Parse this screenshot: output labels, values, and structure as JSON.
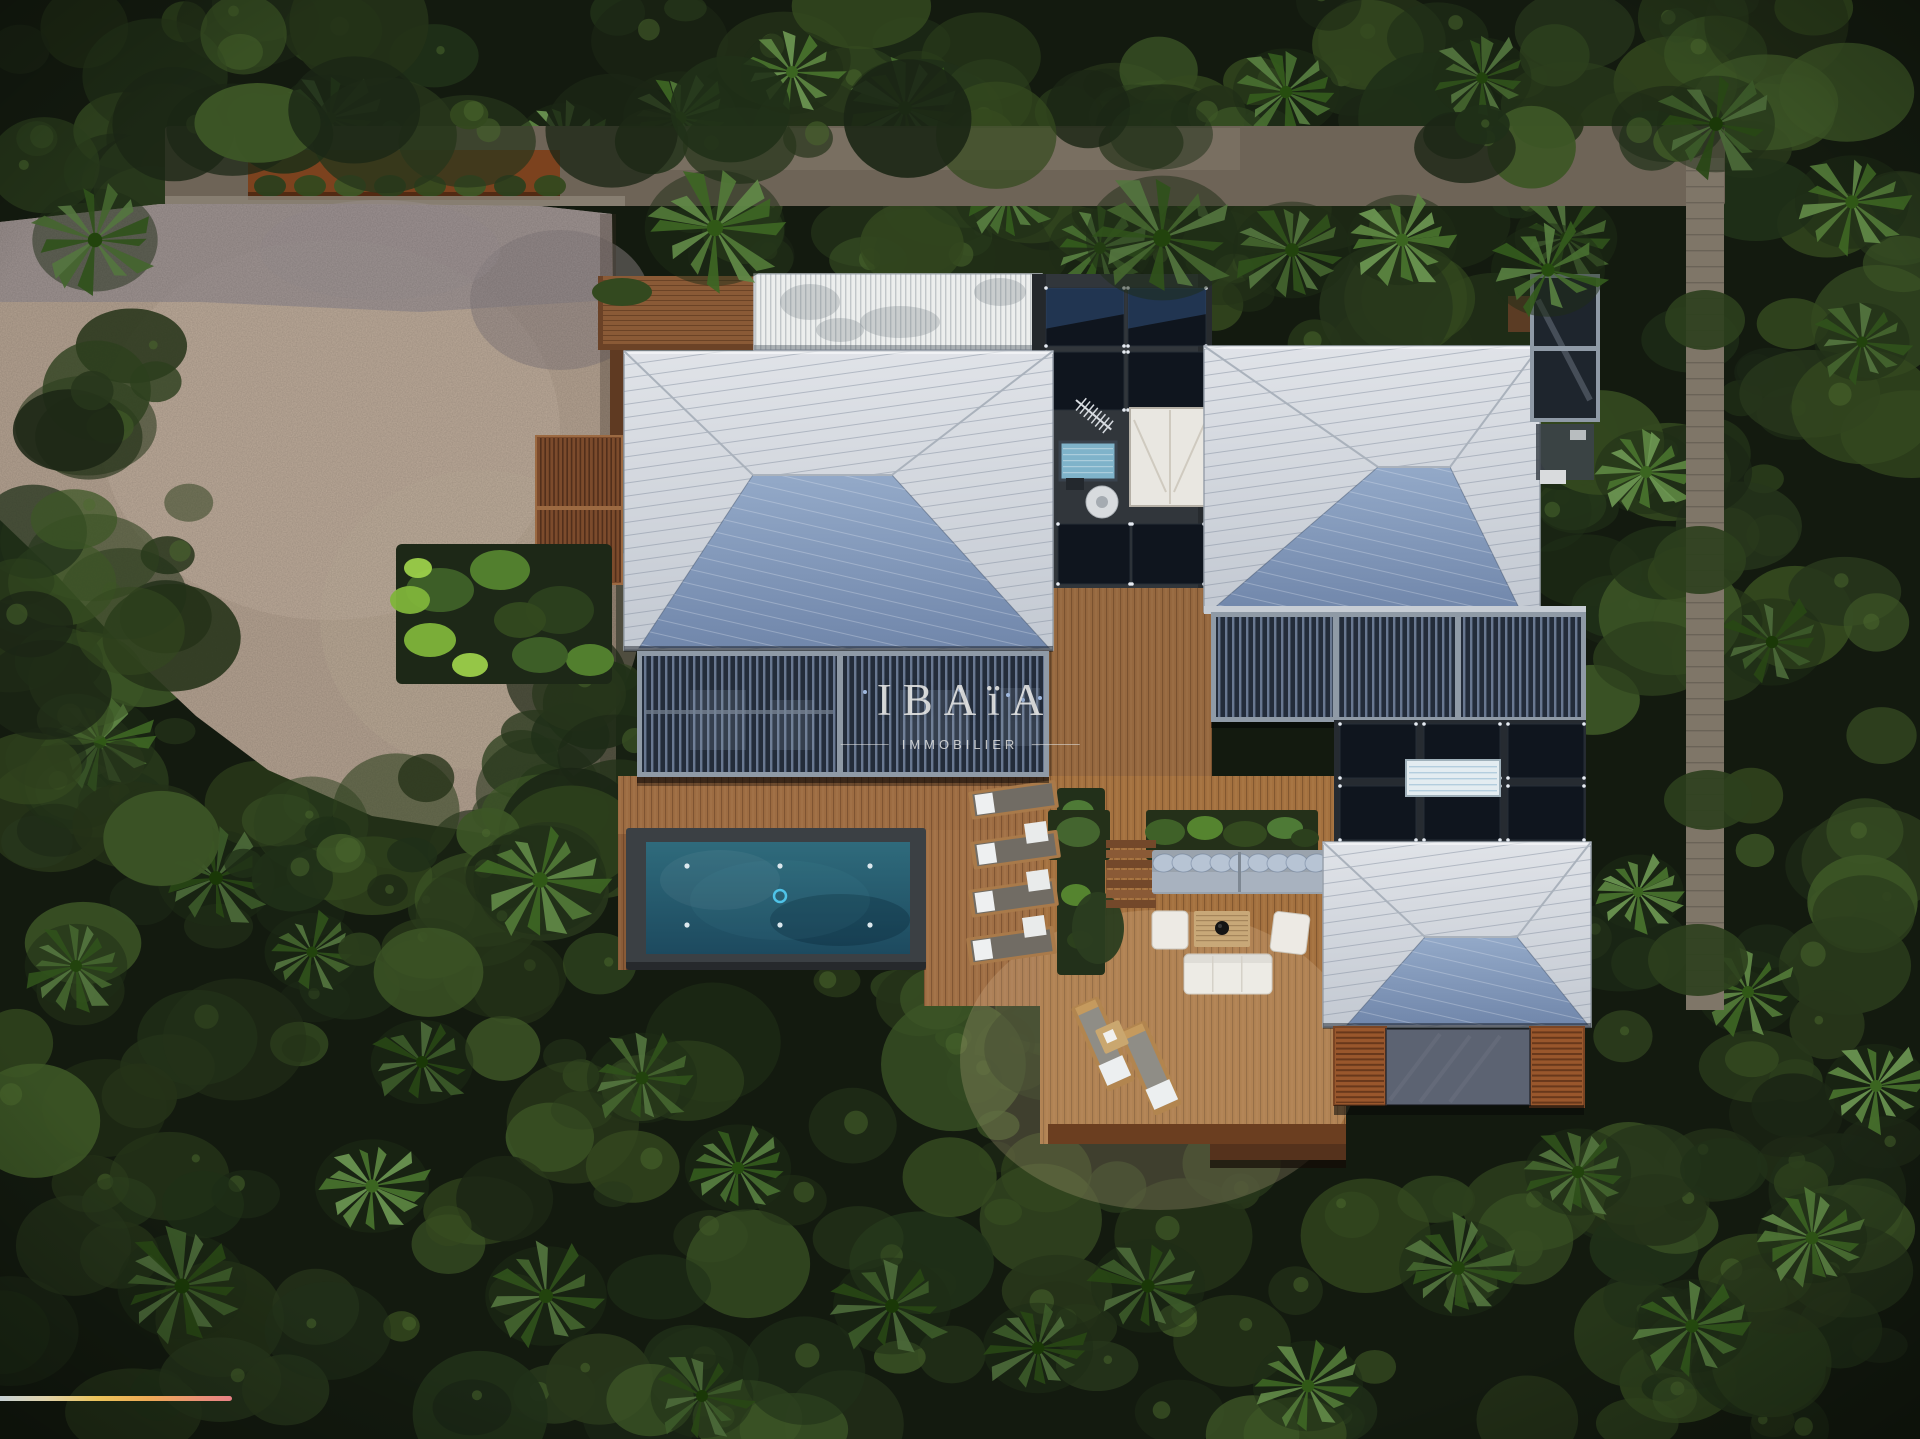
{
  "watermark": {
    "title": "IBAïA",
    "subtitle": "IMMOBILIER"
  },
  "brand_bar": {
    "colors": [
      "#ccd7db",
      "#e6d8ae",
      "#f2c85c",
      "#f5ae58",
      "#f1927c",
      "#ee8489"
    ]
  },
  "palette": {
    "forest_dark": "#131a0f",
    "forest_leaf": "#34491f",
    "roof_silver": "#d0d5dc",
    "roof_steel_blue": "#8099bd",
    "solar_panel": "#0f151e",
    "deck_wood": "#a4713f",
    "pool_water": "#2a5f72",
    "driveway_gravel": "#b3a190",
    "louver_wall": "#232c3a",
    "stone_path": "#7f7668",
    "terracotta_wall": "#7c421e"
  }
}
